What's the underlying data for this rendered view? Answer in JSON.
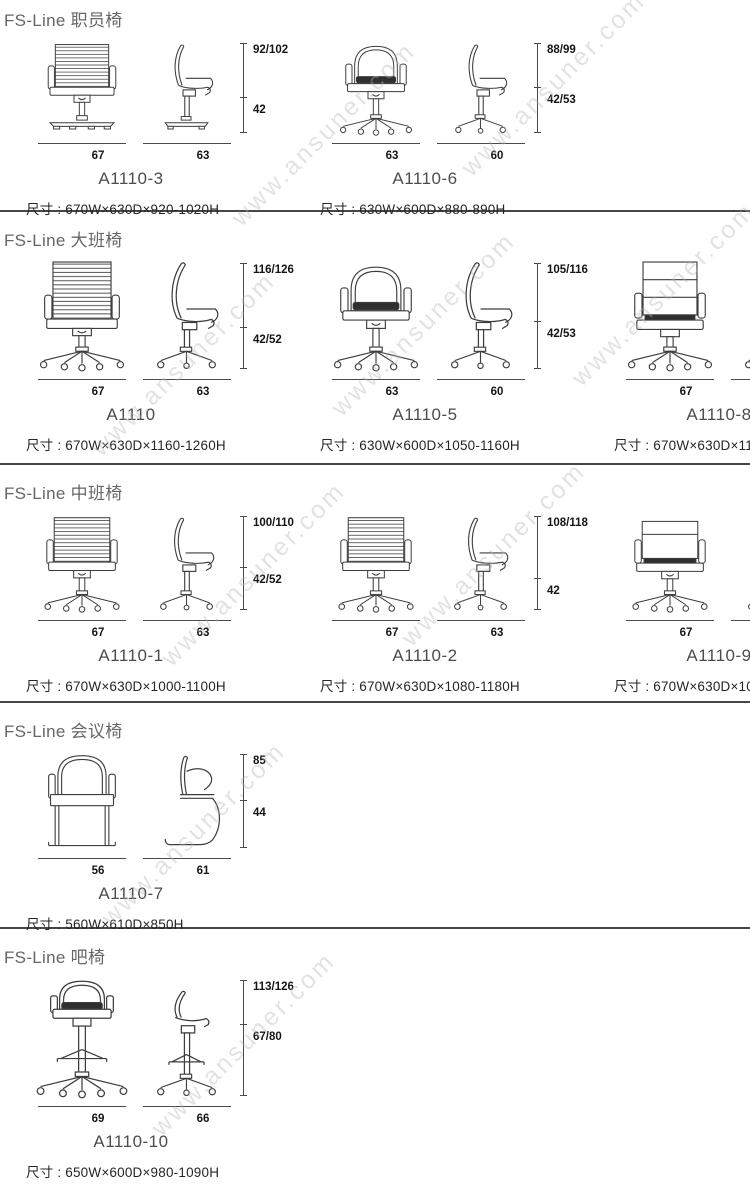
{
  "watermark": "www.ansuner.com",
  "sections": [
    {
      "title": "FS-Line 职员椅",
      "chairs": [
        {
          "model": "A1110-3",
          "size": "尺寸 : 670W×630D×920-1020H",
          "dim_top": "92/102",
          "dim_bottom": "42",
          "front_width": "67",
          "side_width": "63"
        },
        {
          "model": "A1110-6",
          "size": "尺寸 : 630W×600D×880-890H",
          "dim_top": "88/99",
          "dim_bottom": "42/53",
          "front_width": "63",
          "side_width": "60"
        }
      ]
    },
    {
      "title": "FS-Line 大班椅",
      "chairs": [
        {
          "model": "A1110",
          "size": "尺寸 : 670W×630D×1160-1260H",
          "dim_top": "116/126",
          "dim_bottom": "42/52",
          "front_width": "67",
          "side_width": "63"
        },
        {
          "model": "A1110-5",
          "size": "尺寸 : 630W×600D×1050-1160H",
          "dim_top": "105/116",
          "dim_bottom": "42/53",
          "front_width": "63",
          "side_width": "60"
        },
        {
          "model": "A1110-8",
          "size": "尺寸 : 670W×630D×1160-1260H",
          "dim_top": "116/126",
          "dim_bottom": "42/52",
          "front_width": "67",
          "side_width": "63"
        }
      ]
    },
    {
      "title": "FS-Line 中班椅",
      "chairs": [
        {
          "model": "A1110-1",
          "size": "尺寸 : 670W×630D×1000-1100H",
          "dim_top": "100/110",
          "dim_bottom": "42/52",
          "front_width": "67",
          "side_width": "63"
        },
        {
          "model": "A1110-2",
          "size": "尺寸 : 670W×630D×1080-1180H",
          "dim_top": "108/118",
          "dim_bottom": "42",
          "front_width": "67",
          "side_width": "63"
        },
        {
          "model": "A1110-9",
          "size": "尺寸 : 670W×630D×1000-1100H",
          "dim_top": "100/110",
          "dim_bottom": "42/52",
          "front_width": "67",
          "side_width": "63"
        }
      ]
    },
    {
      "title": "FS-Line 会议椅",
      "chairs": [
        {
          "model": "A1110-7",
          "size": "尺寸 : 560W×610D×850H",
          "dim_top": "85",
          "dim_bottom": "44",
          "front_width": "56",
          "side_width": "61"
        }
      ]
    },
    {
      "title": "FS-Line 吧椅",
      "chairs": [
        {
          "model": "A1110-10",
          "size": "尺寸 : 650W×600D×980-1090H",
          "dim_top": "113/126",
          "dim_bottom": "67/80",
          "front_width": "69",
          "side_width": "66"
        }
      ]
    }
  ]
}
